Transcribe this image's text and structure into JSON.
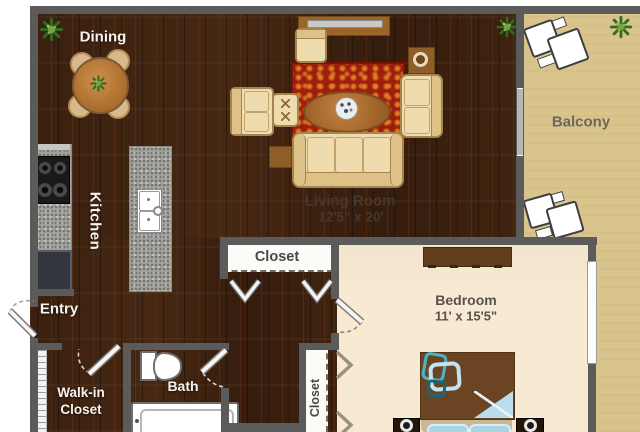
{
  "plan_title": "apartment floor plan",
  "rooms": {
    "dining": {
      "label": "Dining"
    },
    "kitchen": {
      "label": "Kitchen"
    },
    "living_room": {
      "label": "Living Room",
      "dims": "12'5\" x 20'"
    },
    "balcony": {
      "label": "Balcony"
    },
    "bedroom": {
      "label": "Bedroom",
      "dims": "11' x 15'5\""
    },
    "entry": {
      "label": "Entry"
    },
    "walk_in_closet": {
      "label": "Walk-in Closet"
    },
    "bath": {
      "label": "Bath"
    },
    "closet_hall": {
      "label": "Closet"
    },
    "closet_bedroom": {
      "label": "Closet"
    }
  },
  "colors": {
    "wood_floor": "#3b2010",
    "bedroom_floor": "#f7e9d2",
    "balcony_floor": "#d9c48c",
    "wall": "#5b5b5b",
    "rug_red": "#9e1d0d",
    "upholstery_cream": "#eedcae",
    "bed_brown": "#6b4423",
    "accent_light_blue": "#b9dded",
    "accent_teal": "#2e9db3"
  }
}
